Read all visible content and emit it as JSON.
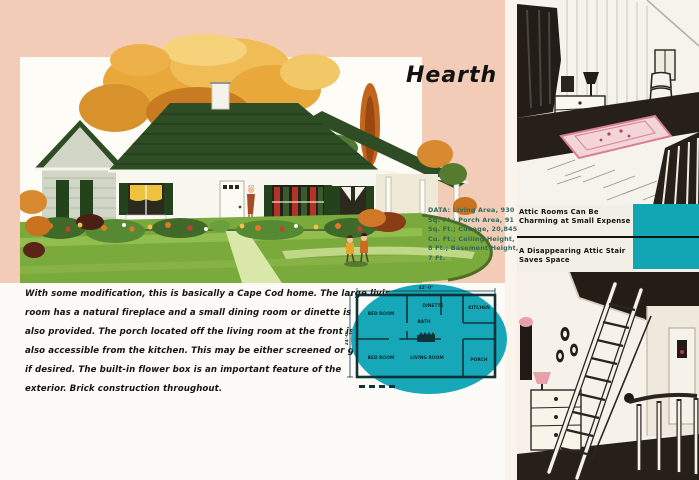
{
  "left_page": {
    "title": "Hearth",
    "data_block": [
      "DATA: Living Area, 930",
      "Sq. Ft.; Porch Area, 91",
      "Sq. Ft.; Cubage, 20,845",
      "Cu. Ft.; Ceiling Height,",
      "8 Ft.; Basement Height,",
      "7 Ft."
    ],
    "description": [
      "With some modification, this is basically a Cape Cod home. The large living",
      "room has a natural fireplace and a small dining room or dinette is",
      "also provided. The porch located off the living room at the front is",
      "also accessible from the kitchen. This may be either screened or glazed,",
      "if desired. The built-in flower box is an important feature of the",
      "exterior. Brick construction throughout."
    ],
    "floor_plan": {
      "dim_top": "42'-0\"",
      "dim_left": "24'-0\"",
      "rooms": [
        "BED ROOM",
        "BATH",
        "DINETTE",
        "KITCHEN",
        "BED ROOM",
        "LIVING ROOM",
        "PORCH"
      ]
    }
  },
  "right_page": {
    "caption_top": [
      "Attic Rooms Can Be",
      "Charming at Small Expense"
    ],
    "caption_bottom": [
      "A Disappearing Attic Stair",
      "Saves Space"
    ]
  },
  "colors": {
    "background_peach": "#f2ccb6",
    "accent_teal": "#12a5b4",
    "roof_green": "#2e4d24",
    "lawn_green": "#7aa93c"
  }
}
